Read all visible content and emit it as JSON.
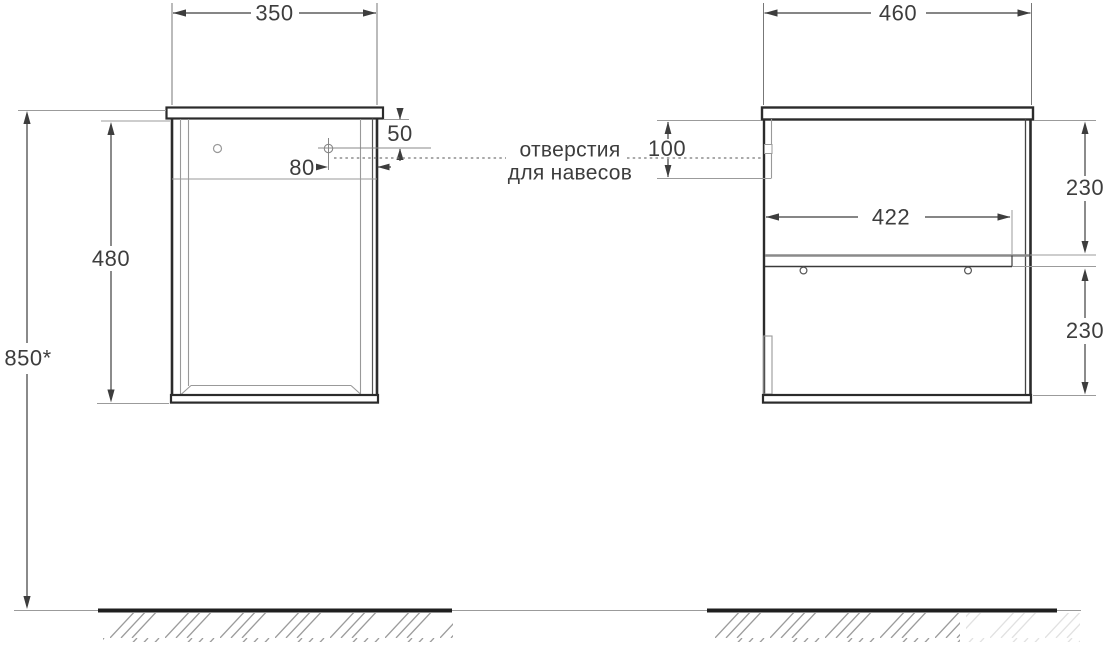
{
  "drawing": {
    "annotation": {
      "line1": "отверстия",
      "line2": "для навесов"
    },
    "side_view": {
      "width": "350",
      "body_height": "480",
      "mount_height": "850*",
      "hole_top_offset": "50",
      "hole_side_offset": "80"
    },
    "front_view": {
      "width": "460",
      "shelf_width": "422",
      "hanger_offset": "100",
      "upper_section": "230",
      "lower_section": "230"
    },
    "colors": {
      "cabinet_outline": "#2b2b2b",
      "dimension": "#3d3d3d",
      "extension_line": "#9b9b9b",
      "ground": "#1f1f1f"
    }
  }
}
